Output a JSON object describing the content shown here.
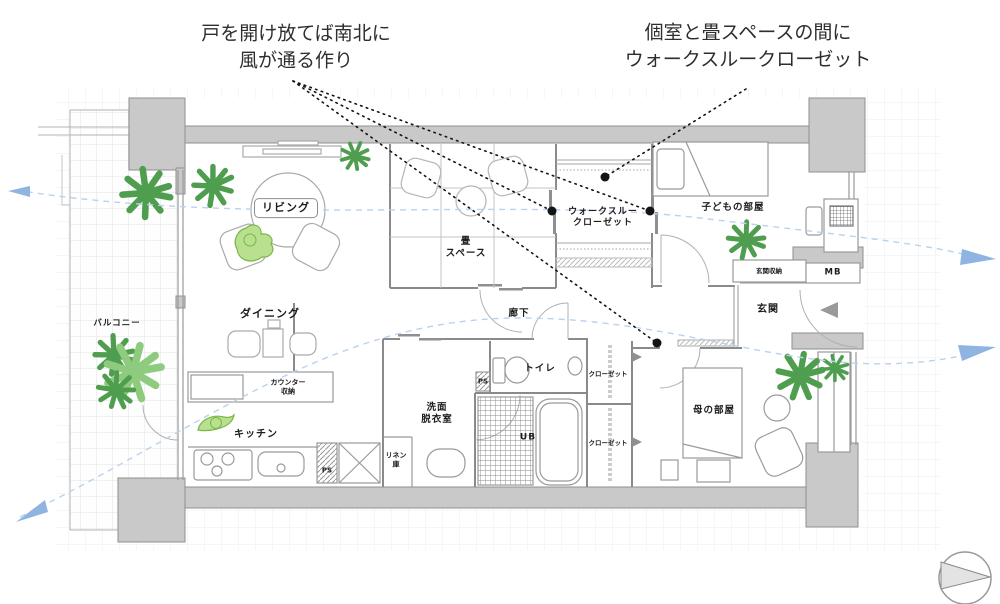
{
  "annotations": {
    "left": "戸を開け放てば南北に\n風が通る作り",
    "right": "個室と畳スペースの間に\nウォークスルークローゼット"
  },
  "rooms": {
    "living": "リビング",
    "tatami": "畳\nスペース",
    "wtc": "ウォークスルー\nクローゼット",
    "kids": "子どもの部屋",
    "balcony": "バルコニー",
    "dining": "ダイニング",
    "counter": "カウンター\n収納",
    "kitchen": "キッチン",
    "hallway": "廊下",
    "toilet": "トイレ",
    "washroom": "洗面\n脱衣室",
    "ub": "UB",
    "linen": "リネン\n庫",
    "closet_upper": "クローゼット",
    "closet_lower": "クローゼット",
    "mother": "母の部屋",
    "entrance": "玄関",
    "entrance_storage": "玄関収納",
    "mb": "MB",
    "ps_kitchen": "PS",
    "ps_toilet": "PS"
  },
  "colors": {
    "wall_gray": "#c9c9c9",
    "line_gray": "#8f8f8f",
    "plant_green": "#4f9e4f",
    "plant_light": "#8fcb7f",
    "accent_leaf": "#b9e08e",
    "wind_blue": "#aac9e9",
    "leader_black": "#141414",
    "grid": "#ececec"
  }
}
